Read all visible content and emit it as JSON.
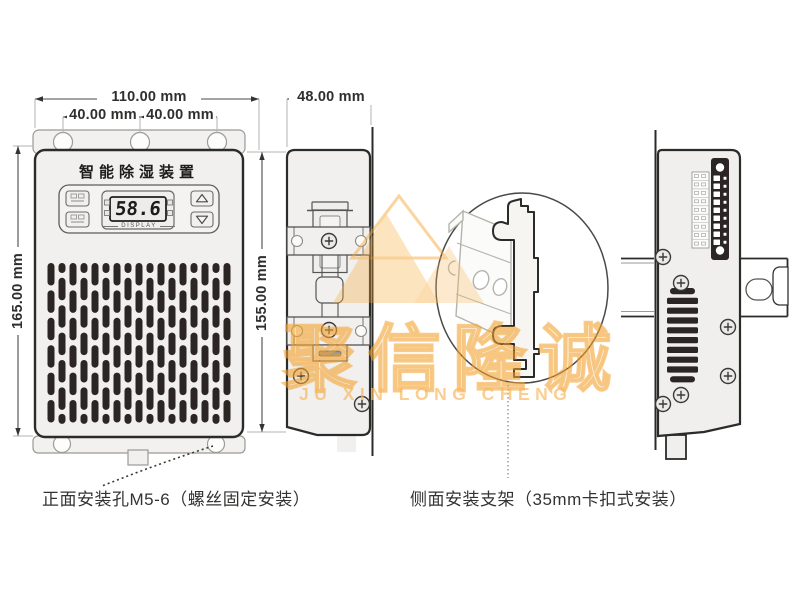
{
  "watermark": {
    "cn": "聚信隆诚",
    "en": "JU XIN LONG CHENG",
    "accent_color": "#F3A63A"
  },
  "front_view": {
    "title": "智能除湿装置",
    "display_value": "58.6",
    "display_label": "DISPLAY",
    "dim_width": "110.00 mm",
    "dim_hole_left": "40.00 mm",
    "dim_hole_right": "40.00 mm",
    "dim_height": "165.00 mm"
  },
  "side_view": {
    "dim_width": "48.00 mm",
    "dim_height": "155.00 mm"
  },
  "annotations": {
    "front_mount": "正面安装孔M5-6（螺丝固定安装）",
    "side_mount": "侧面安装支架（35mm卡扣式安装）"
  },
  "patterns": {
    "grille_columns": 17,
    "grille_rows": 6,
    "vent_bars": 10,
    "terminal_count": 9
  },
  "colors": {
    "line_dark": "#2b2b29",
    "line_mid": "#555553",
    "line_light": "#b3b3b0",
    "body_fill": "#f1f0ee",
    "slot_fill": "#2b2523"
  }
}
